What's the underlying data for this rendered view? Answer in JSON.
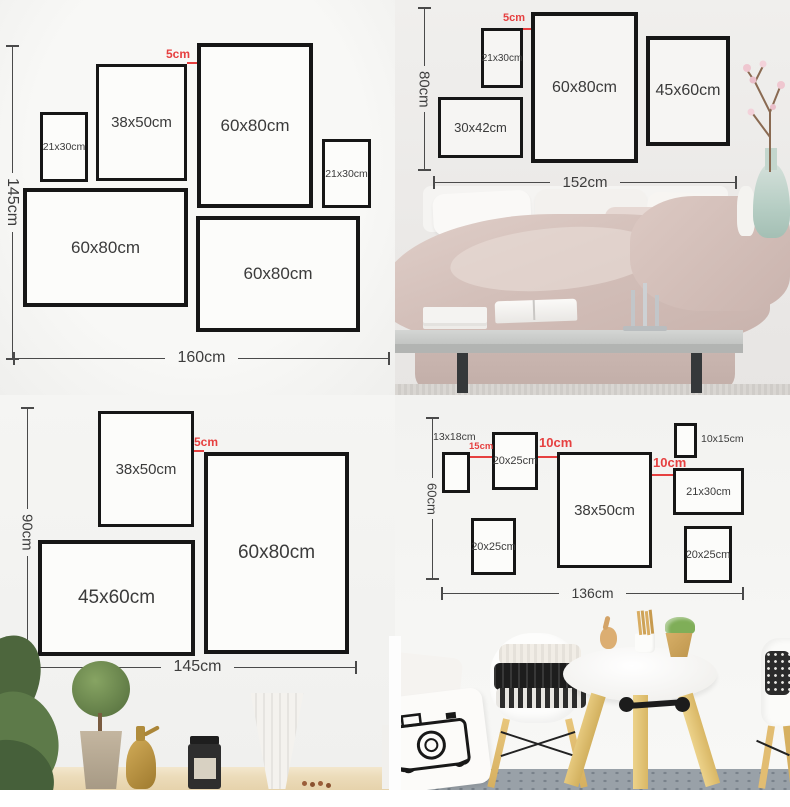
{
  "colors": {
    "accent_red": "#e64040",
    "frame_border": "#161616",
    "dimension_line": "#4a4a4a",
    "label_text": "#3d3d3d"
  },
  "q1": {
    "height_label": "145cm",
    "width_label": "160cm",
    "gap_label": "5cm",
    "frames": [
      {
        "label": "21x30cm"
      },
      {
        "label": "38x50cm"
      },
      {
        "label": "60x80cm"
      },
      {
        "label": "21x30cm"
      },
      {
        "label": "60x80cm"
      },
      {
        "label": "60x80cm"
      }
    ]
  },
  "q2": {
    "height_label": "80cm",
    "width_label": "152cm",
    "gap_label": "5cm",
    "frames": [
      {
        "label": "21x30cm"
      },
      {
        "label": "60x80cm"
      },
      {
        "label": "45x60cm"
      },
      {
        "label": "30x42cm"
      }
    ]
  },
  "q3": {
    "height_label": "90cm",
    "width_label": "145cm",
    "gap_label": "5cm",
    "frames": [
      {
        "label": "38x50cm"
      },
      {
        "label": "60x80cm"
      },
      {
        "label": "45x60cm"
      }
    ]
  },
  "q4": {
    "height_label": "60cm",
    "width_label": "136cm",
    "gaps": [
      {
        "label": "15cm"
      },
      {
        "label": "10cm"
      },
      {
        "label": "10cm"
      }
    ],
    "frames": [
      {
        "label": "13x18cm"
      },
      {
        "label": "20x25cm"
      },
      {
        "label": "38x50cm"
      },
      {
        "label": "10x15cm"
      },
      {
        "label": "21x30cm"
      },
      {
        "label": "20x25cm"
      },
      {
        "label": "20x25cm"
      }
    ]
  }
}
